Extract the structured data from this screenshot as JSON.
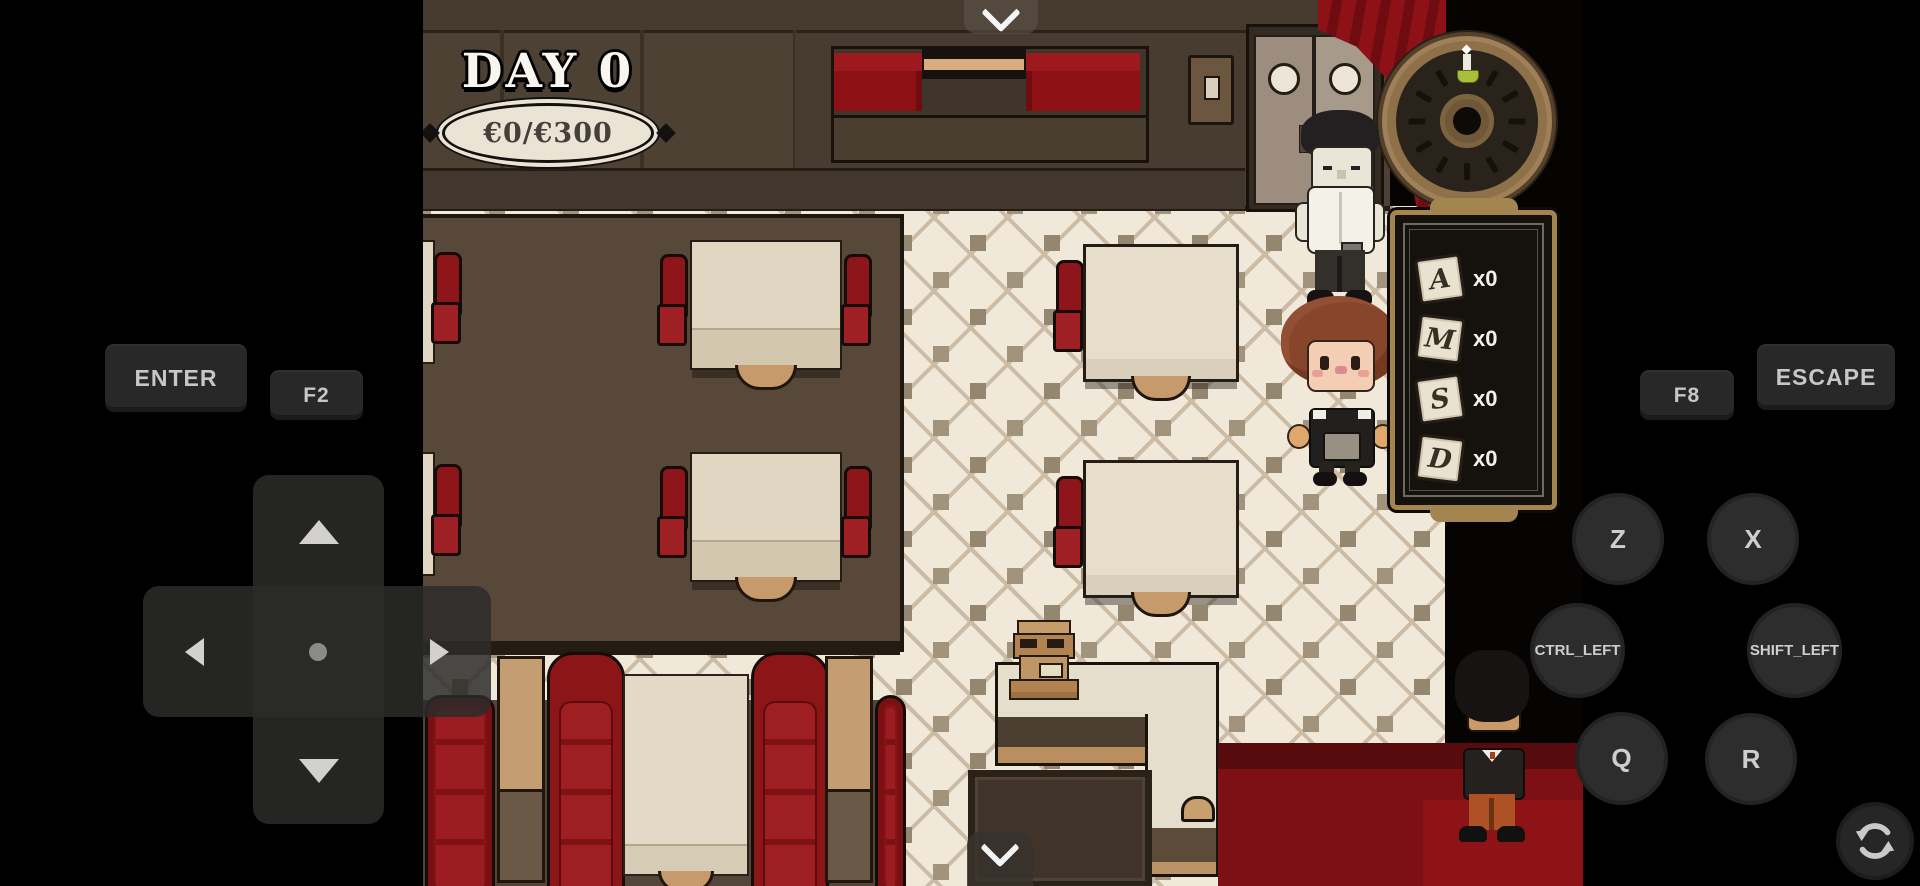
{
  "hud": {
    "day": "DAY 0",
    "money": "€0/€300"
  },
  "ticket_panel": {
    "items": [
      {
        "letter": "A",
        "count": "x0"
      },
      {
        "letter": "M",
        "count": "x0"
      },
      {
        "letter": "S",
        "count": "x0"
      },
      {
        "letter": "D",
        "count": "x0"
      }
    ]
  },
  "controls": {
    "enter": "ENTER",
    "f2": "F2",
    "f8": "F8",
    "escape": "ESCAPE",
    "z": "Z",
    "x": "X",
    "ctrl_left": "CTRL_LEFT",
    "shift_left": "SHIFT_LEFT",
    "q": "Q",
    "r": "R"
  },
  "icons": {
    "top_handle": "chevron-down",
    "bottom_handle": "chevron-down",
    "rotate_button": "rotate-circular-arrows",
    "dpad": "directional-pad",
    "clock": "wall-clock"
  },
  "colors": {
    "booth_red": "#8c1014",
    "carpet_red": "#7c1014",
    "floor_cream": "#f0e9da",
    "wall_brown": "#4d4134",
    "panel_border_tan": "#a3854f",
    "control_bg": "#282828",
    "control_text": "#c7c7c7"
  }
}
